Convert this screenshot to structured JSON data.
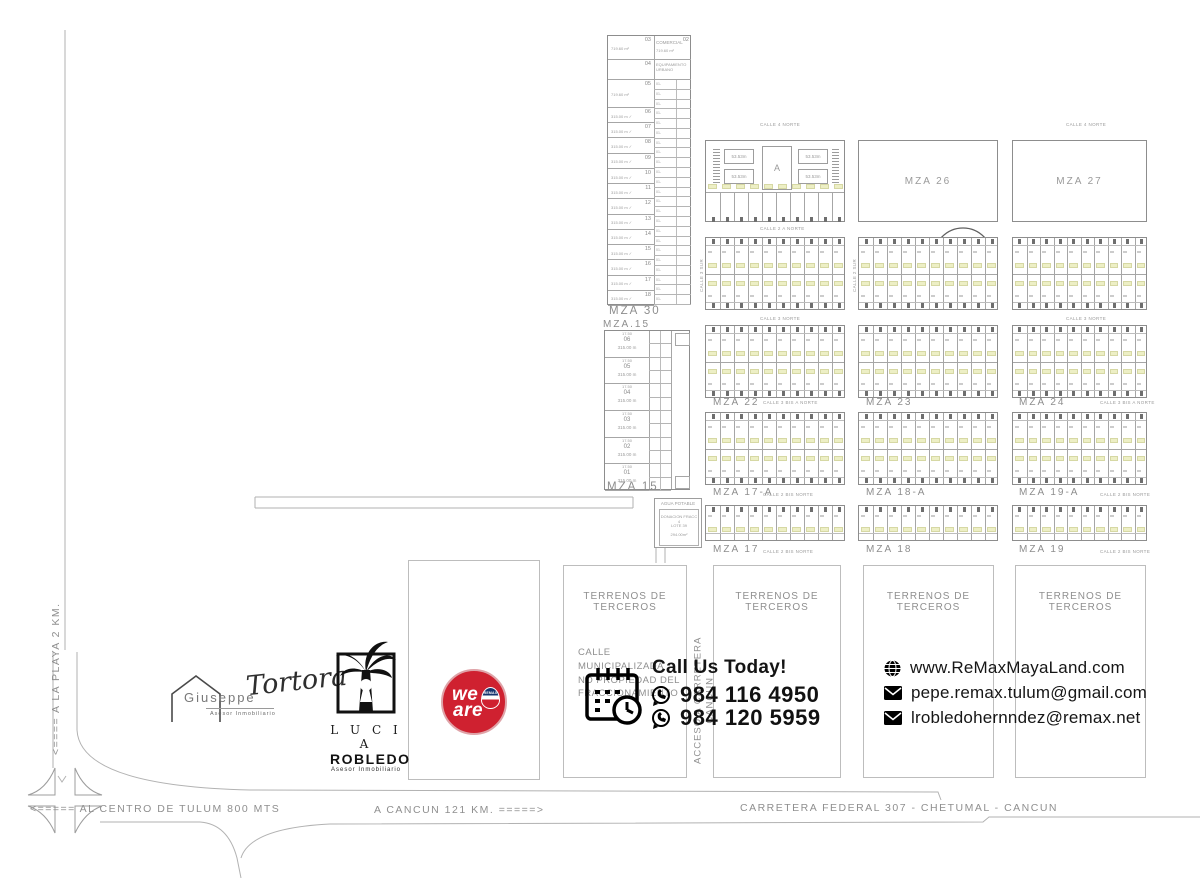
{
  "colors": {
    "map_line": "#a6a6a6",
    "block_border": "#8d8d8d",
    "map_text": "#8f8f8f",
    "lot_highlight": "#edefc5",
    "ink": "#141414",
    "remax_red": "#cf2130",
    "remax_blue": "#16356e"
  },
  "map": {
    "mza30": {
      "label": "MZA 30",
      "lot03": {
        "num": "03",
        "area": "719.60 m²"
      },
      "comercial": {
        "label": "COMERCIAL",
        "num": "02",
        "area": "719.60 m²"
      },
      "equipamiento": {
        "label": "EQUIPAMIENTO URBANO",
        "num": "04"
      },
      "lot05": {
        "num": "05",
        "area": "719.60 m²"
      },
      "left_lots": [
        "06",
        "07",
        "08",
        "09",
        "10",
        "11",
        "12",
        "13",
        "14",
        "15",
        "16",
        "17",
        "18"
      ],
      "left_lot_area": "315.00 m ✓",
      "right_lot_prefix": "01-"
    },
    "mza15": {
      "label_top": "MZA.15",
      "label_bottom": "MZA 15",
      "lots": [
        "06",
        "05",
        "04",
        "03",
        "02",
        "01"
      ],
      "lot_area": "315.00 m",
      "lot_width": "17.50"
    },
    "agua_potable": {
      "title": "AGUA POTABLE",
      "lines": [
        "DONACION FRACC 4",
        "LOTE 39",
        "294.00m²"
      ]
    },
    "grid": {
      "row1_labels": [
        "A",
        "MZA 26",
        "MZA 27"
      ],
      "row3_labels": [
        "MZA 22",
        "MZA 23",
        "MZA 24"
      ],
      "row4_labels": [
        "MZA 17-A",
        "MZA 18-A",
        "MZA 19-A"
      ],
      "row5_labels": [
        "MZA 17",
        "MZA 18",
        "MZA 19"
      ],
      "plaza_cell_dim": "53.53m",
      "grid_lot_width": "8.00m"
    },
    "streets": {
      "calle4norte": "CALLE 4 NORTE",
      "calle2anorte": "CALLE 2 A NORTE",
      "calle3norte": "CALLE 3 NORTE",
      "calle3bisanorte": "CALLE 3 BIS A NORTE",
      "calle2bisnorte": "CALLE 2 BIS NORTE",
      "calle3sur": "CALLE 3 SUR",
      "calle2sur": "CALLE 2 SUR"
    }
  },
  "bottom": {
    "terrenos_label": "TERRENOS DE TERCEROS",
    "calle_municipalizada": [
      "CALLE MUNICIPALIZADA",
      "NO PROPIEDAD DEL FRACCIONAMIENTO"
    ],
    "acceso_vertical": [
      "ACCESO A CARRETERA",
      "CANCUN"
    ]
  },
  "roads": {
    "playa": "<==== A LA PLAYA 2 KM.",
    "centro": "<===== AL CENTRO DE TULUM  800 MTS",
    "cancun": "A CANCUN 121 KM. =====>",
    "carretera": "CARRETERA FEDERAL 307 - CHETUMAL - CANCUN"
  },
  "logos": {
    "giuseppe": {
      "first": "Giuseppe",
      "last": "Tortora",
      "tagline": "Asesor Inmobiliario"
    },
    "lucia": {
      "first": "L U C I A",
      "last": "ROBLEDO",
      "tagline": "Asesor Inmobiliario"
    },
    "weare": {
      "line1": "we",
      "line2": "are",
      "balloon": "REMAX"
    }
  },
  "contact": {
    "headline": "Call Us Today!",
    "phones": [
      "984 116 4950",
      "984 120 5959"
    ],
    "website": "www.ReMaxMayaLand.com",
    "emails": [
      "pepe.remax.tulum@gmail.com",
      "lrobledohernndez@remax.net"
    ]
  }
}
